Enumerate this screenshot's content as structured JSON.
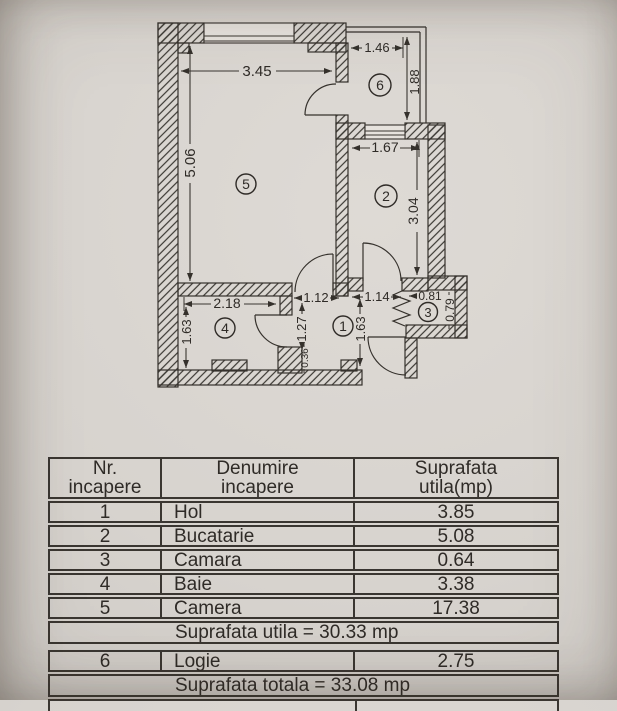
{
  "colors": {
    "paper": "#d7d3ce",
    "ink": "#35312c"
  },
  "plan": {
    "dims": {
      "living_width": "3.45",
      "living_height": "5.06",
      "balcony_width": "1.46",
      "balcony_height": "1.88",
      "kitchen_width": "1.67",
      "kitchen_height": "3.04",
      "bath_width": "2.18",
      "bath_height": "1.63",
      "hall_left_width": "1.12",
      "hall_right_width": "1.14",
      "hall_left_height": "1.27",
      "hall_right_height": "1.63",
      "hall_stub": "0.36",
      "pantry_width": "0.81",
      "pantry_height": "0.79"
    },
    "rooms": {
      "hall": "1",
      "kitchen": "2",
      "pantry": "3",
      "bath": "4",
      "living": "5",
      "balcony": "6"
    }
  },
  "table": {
    "headers": {
      "col1_line1": "Nr.",
      "col1_line2": "incapere",
      "col2_line1": "Denumire",
      "col2_line2": "incapere",
      "col3_line1": "Suprafata",
      "col3_line2": "utila(mp)"
    },
    "rows": [
      {
        "nr": "1",
        "name": "Hol",
        "area": "3.85"
      },
      {
        "nr": "2",
        "name": "Bucatarie",
        "area": "5.08"
      },
      {
        "nr": "3",
        "name": "Camara",
        "area": "0.64"
      },
      {
        "nr": "4",
        "name": "Baie",
        "area": "3.38"
      },
      {
        "nr": "5",
        "name": "Camera",
        "area": "17.38"
      }
    ],
    "summary_utila": "Suprafata utila = 30.33 mp",
    "row_logie": {
      "nr": "6",
      "name": "Logie",
      "area": "2.75"
    },
    "summary_totala": "Suprafata totala = 33.08 mp"
  }
}
